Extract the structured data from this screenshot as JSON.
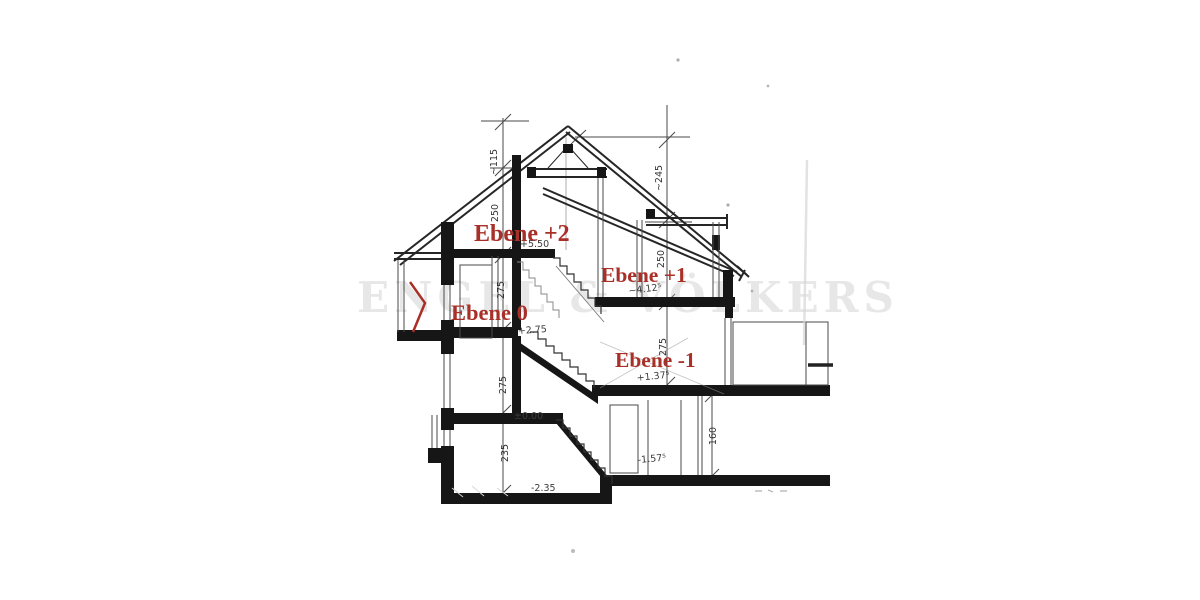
{
  "title": "Building section drawing (scan)",
  "colors": {
    "paper": "#ffffff",
    "ink": "#1f1f1f",
    "accent_red": "#a93028",
    "watermark_gray": "#b5b5b5"
  },
  "watermark": {
    "text": "ENGEL & VÖLKERS"
  },
  "labels": {
    "ebene2": "Ebene +2",
    "ebene1": "Ebene +1",
    "ebene0": "Ebene 0",
    "ebene_m1": "Ebene -1"
  },
  "marks": {
    "m550": "+5.50",
    "m4125": "~4.12⁵",
    "m275": "+2.75",
    "m1375": "+1.37⁵",
    "m000": "±0.00",
    "m1575": "-1.57⁵",
    "m235": "-2.35"
  },
  "dims": {
    "d115": "~115",
    "d250a": "250",
    "d275a": "275",
    "d275b": "275",
    "d235": "235",
    "d245": "~245",
    "d250b": "250",
    "d275c": "275",
    "d160": "160"
  }
}
